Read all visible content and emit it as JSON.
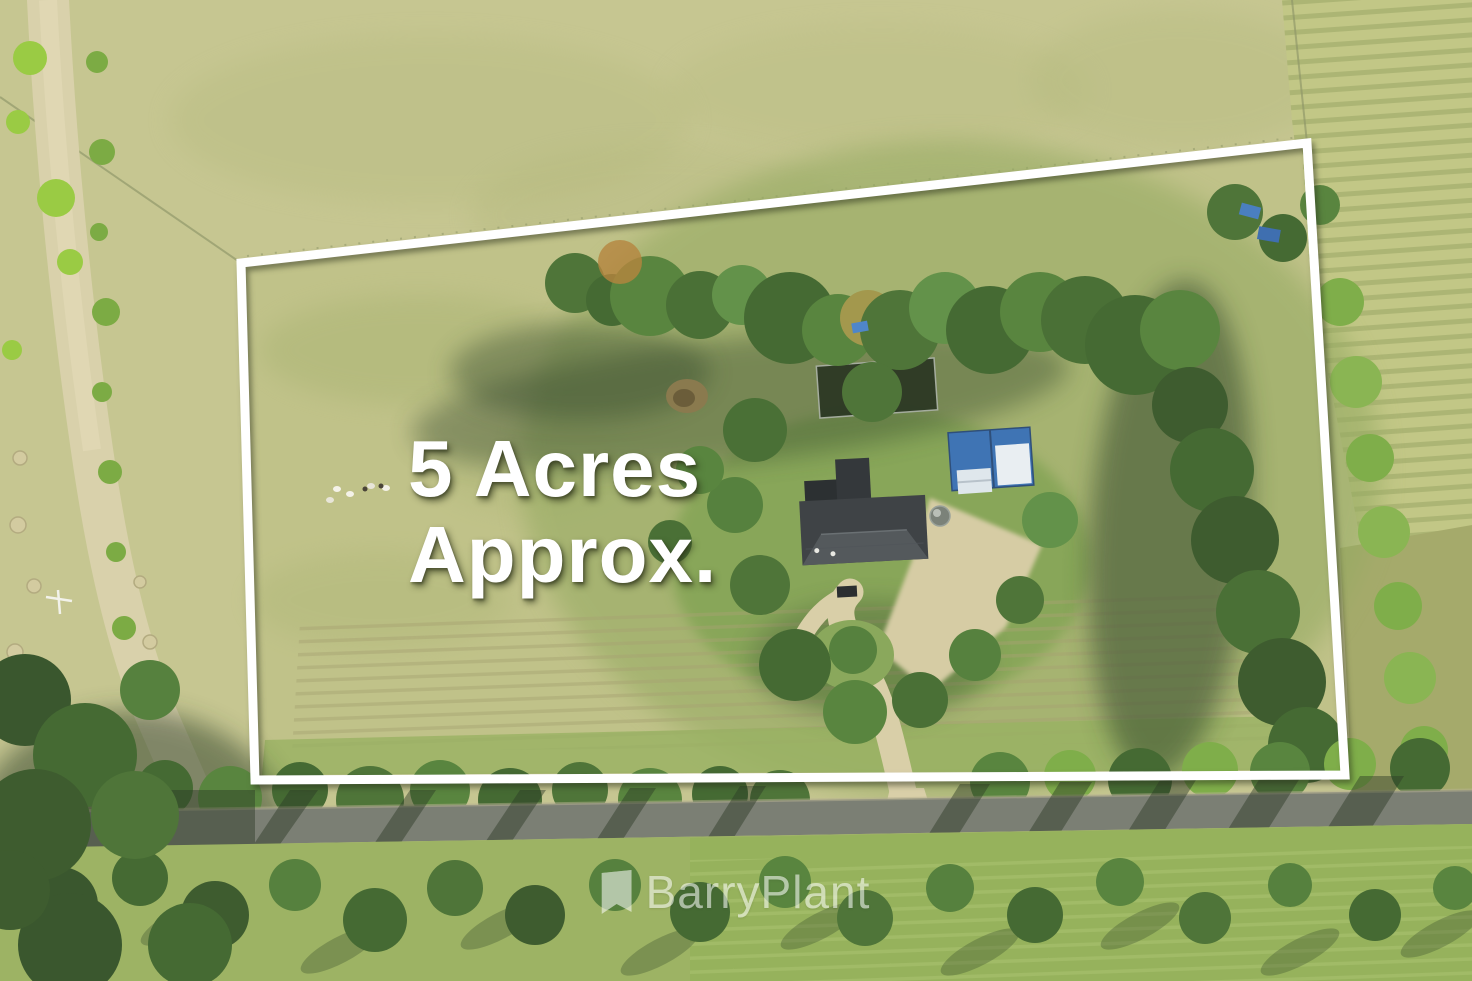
{
  "overlay": {
    "area_line1": "5 Acres",
    "area_line2": "Approx.",
    "text_color": "#ffffff"
  },
  "watermark": {
    "brand": "BarryPlant",
    "icon": "pennant-flag-icon",
    "color": "#ffffff",
    "opacity": "0.55"
  },
  "scene": {
    "boundary_color": "#ffffff",
    "house_roof_color": "#3f4346",
    "shed_roof_blue": "#3f74b4",
    "shed_roof_white": "#e9eef2",
    "sealed_road_color": "#7b7f74",
    "dirt_track_color": "#d9d1ab",
    "driveway_color": "#d9cfa8",
    "field_pale": "#c6c691",
    "paddock_green": "#c0c289",
    "lawn_green": "#7fa251",
    "tree_green_dark": "#3e5c2f",
    "tree_green_light": "#7fae4a",
    "hay_row_color": "#9aa566",
    "tarp_blue": "#4a7fc0"
  }
}
